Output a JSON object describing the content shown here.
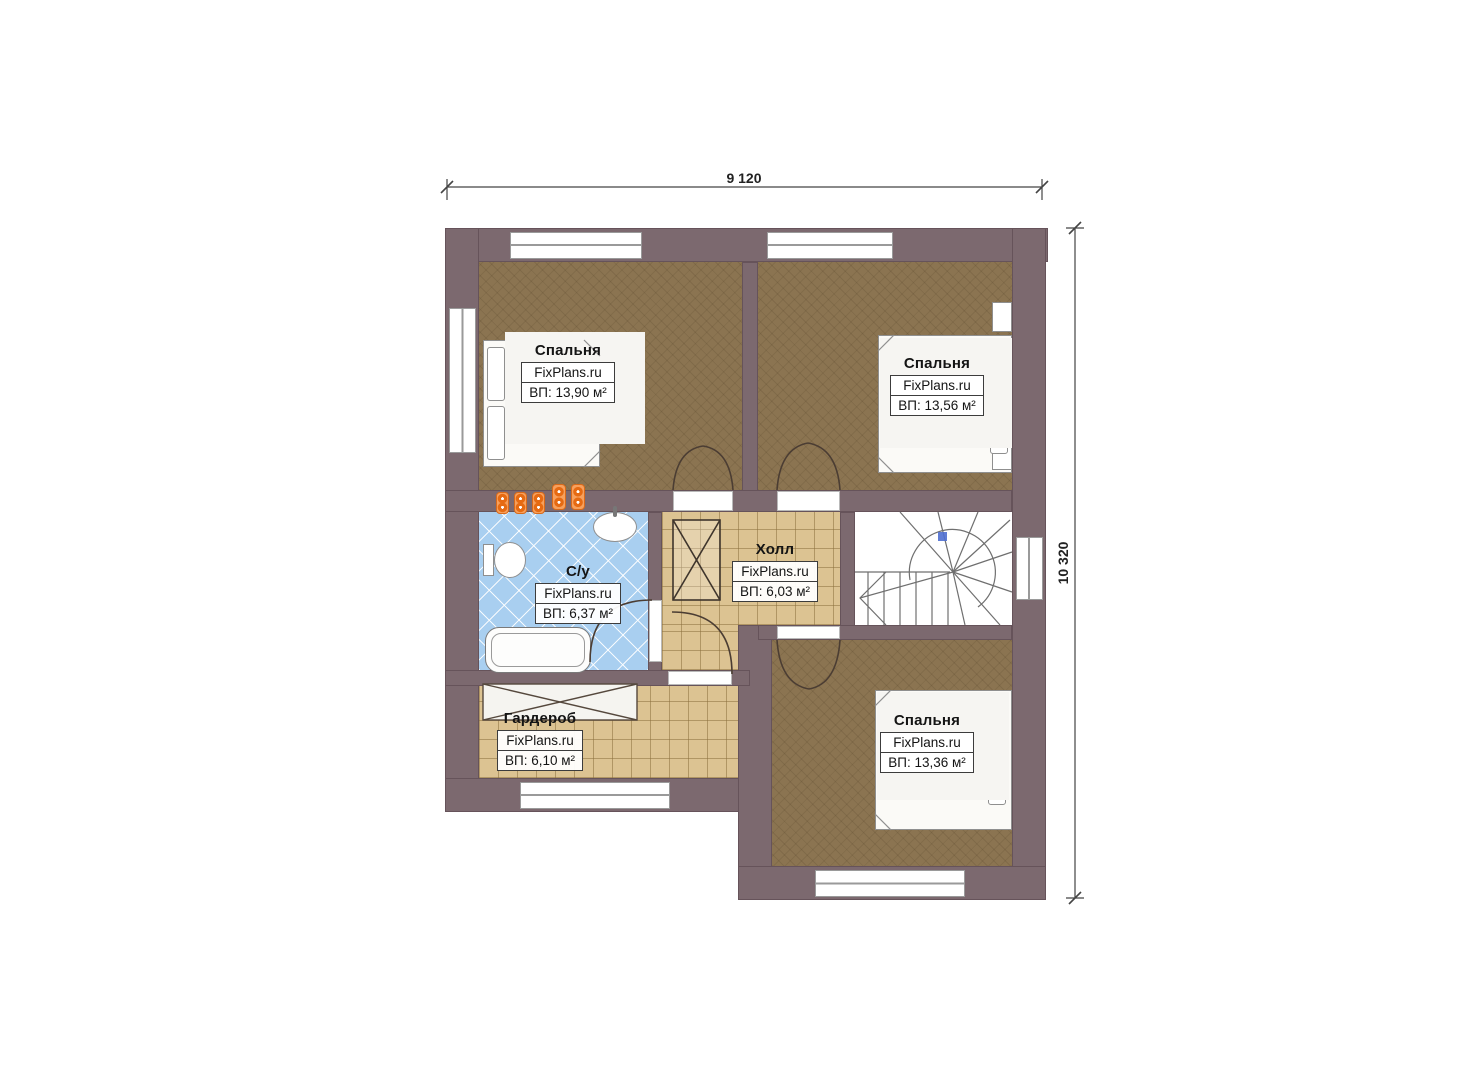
{
  "plan": {
    "type": "floor-plan",
    "dimensions": {
      "width_label": "9 120",
      "height_label": "10 320"
    },
    "rooms": [
      {
        "name": "Спальня",
        "brand": "FixPlans.ru",
        "area": "ВП: 13,90 м²"
      },
      {
        "name": "Спальня",
        "brand": "FixPlans.ru",
        "area": "ВП: 13,56 м²"
      },
      {
        "name": "С/у",
        "brand": "FixPlans.ru",
        "area": "ВП: 6,37 м²"
      },
      {
        "name": "Холл",
        "brand": "FixPlans.ru",
        "area": "ВП: 6,03 м²"
      },
      {
        "name": "Гардероб",
        "brand": "FixPlans.ru",
        "area": "ВП: 6,10 м²"
      },
      {
        "name": "Спальня",
        "brand": "FixPlans.ru",
        "area": "ВП: 13,36 м²"
      }
    ],
    "colors": {
      "wall": "#7c696f",
      "bedroom_floor": "#8b7451",
      "hall_floor": "#dcc392",
      "bath_floor": "#a9cff0",
      "radiator": "#f7a05c",
      "stair_marker": "#4f6fd0"
    }
  }
}
